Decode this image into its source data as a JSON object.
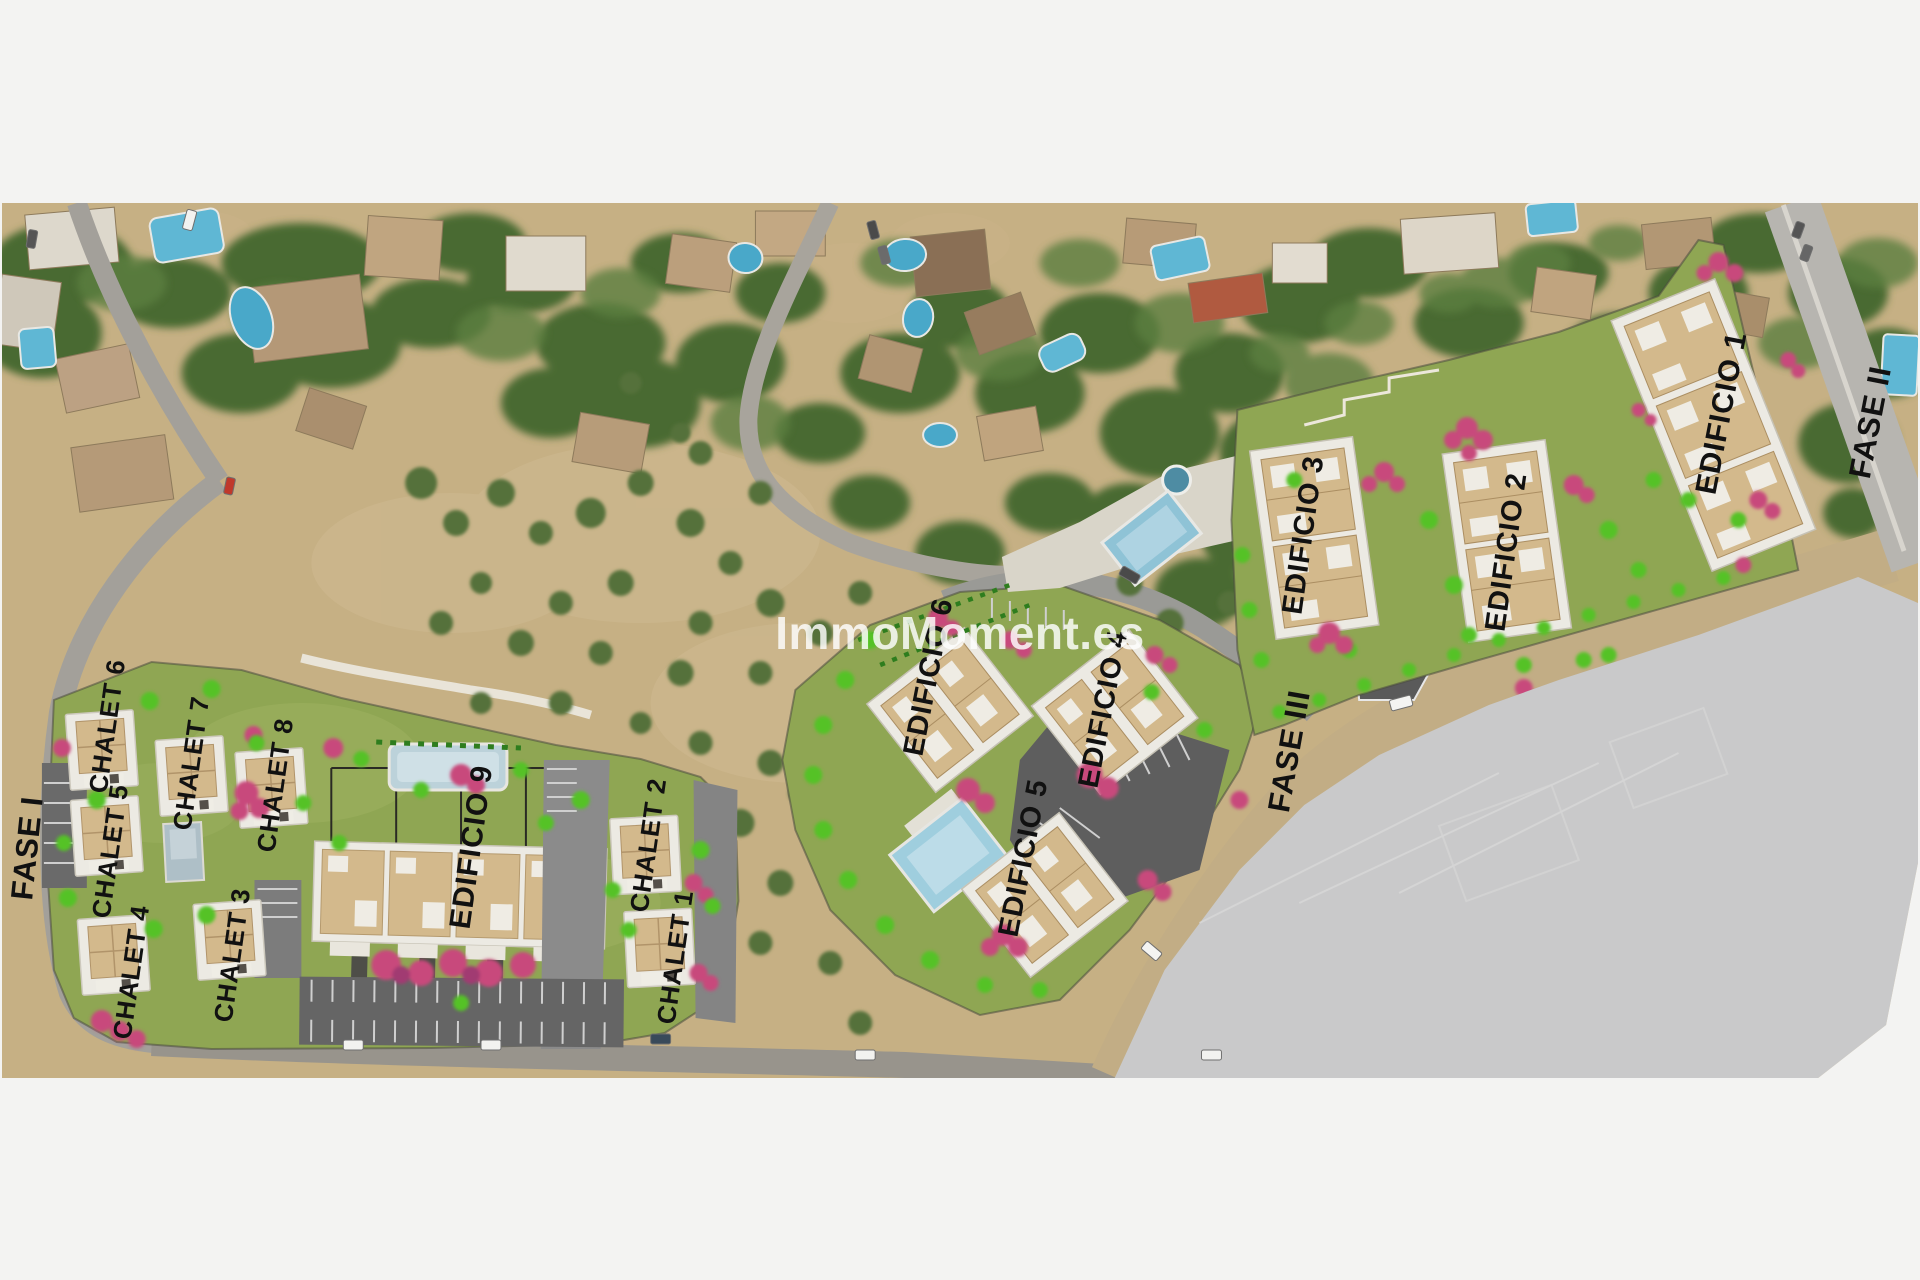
{
  "watermark": {
    "text": "ImmoMoment.es"
  },
  "labels": {
    "fase1": "FASE I",
    "fase2": "FASE II",
    "fase3": "FASE III",
    "chalet1": "CHALET 1",
    "chalet2": "CHALET 2",
    "chalet3": "CHALET 3",
    "chalet4": "CHALET 4",
    "chalet5": "CHALET 5",
    "chalet6": "CHALET 6",
    "chalet7": "CHALET 7",
    "chalet8": "CHALET 8",
    "edificio1": "EDIFICIO 1",
    "edificio2": "EDIFICIO 2",
    "edificio3": "EDIFICIO 3",
    "edificio4": "EDIFICIO 4",
    "edificio5": "EDIFICIO 5",
    "edificio6": "EDIFICIO 6",
    "edificio9": "EDIFICIO 9"
  },
  "colors": {
    "background": "#f3f3f2",
    "label_text": "#111111",
    "watermark_text": "#ffffff",
    "lawn": "#8fa653",
    "dirt": "#c6b084",
    "asphalt": "#9d9d9d",
    "road_beige": "#c2ad85",
    "dark_parking": "#5f5f5f",
    "paved_area": "#c9c9ca",
    "pool_blue": "#7fb8cf",
    "bush_green": "#55c228",
    "tree_pink": "#c84a7c",
    "building_tan": "#d3b98c",
    "building_white": "#eceae3",
    "vegetation_dark": "#4a6b33"
  }
}
